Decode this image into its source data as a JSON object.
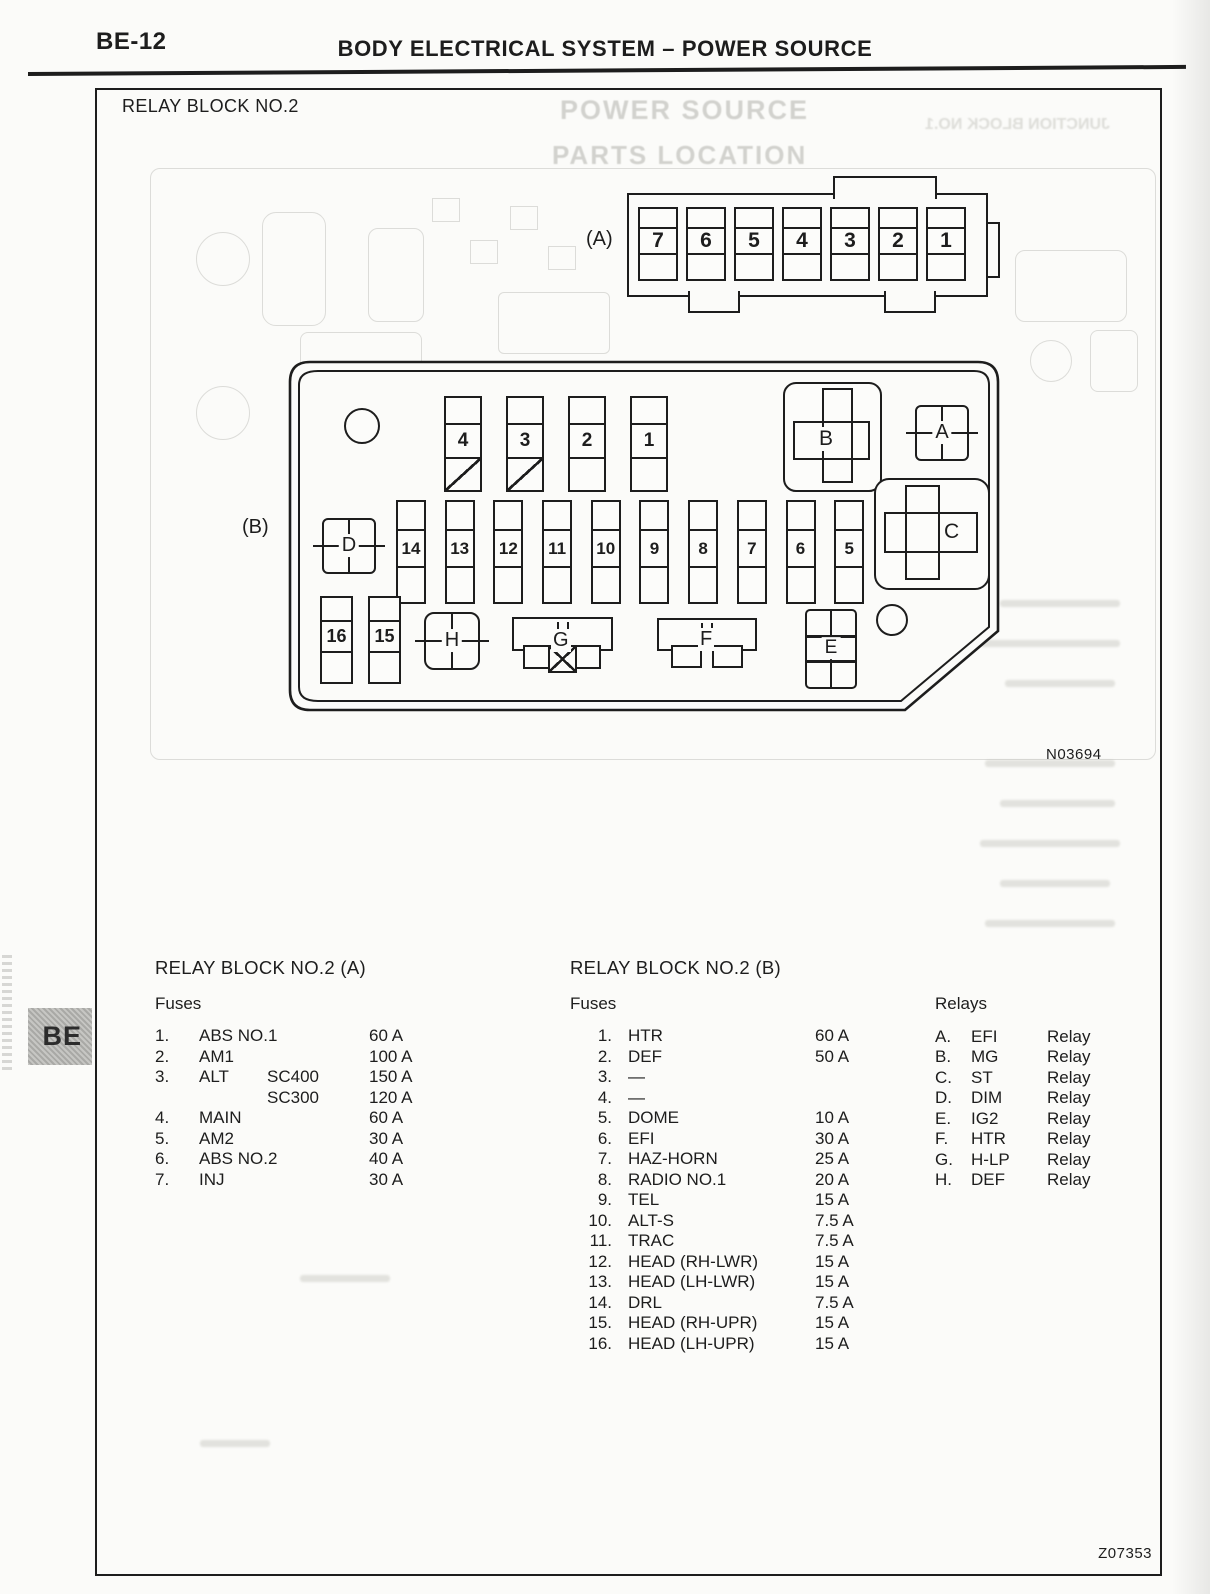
{
  "page": {
    "page_number": "BE-12",
    "header_title": "BODY ELECTRICAL SYSTEM – POWER SOURCE",
    "section_title": "RELAY BLOCK NO.2",
    "figure_code": "N03694",
    "page_code": "Z07353",
    "side_tab": "BE"
  },
  "ghost": {
    "bleed_line1": "POWER SOURCE",
    "bleed_line2": "PARTS LOCATION",
    "bleed_line3": "JUNCTION BLOCK NO.1"
  },
  "diagram": {
    "connector_a": {
      "label": "(A)",
      "slots": [
        "7",
        "6",
        "5",
        "4",
        "3",
        "2",
        "1"
      ]
    },
    "block_b": {
      "label": "(B)",
      "top_fuses": [
        "4",
        "3",
        "2",
        "1"
      ],
      "mid_fuses": [
        "14",
        "13",
        "12",
        "11",
        "10",
        "9",
        "8",
        "7",
        "6",
        "5"
      ],
      "bottom_fuses": [
        "16",
        "15"
      ],
      "relay_letters": [
        "A",
        "B",
        "C",
        "D",
        "E",
        "F",
        "G",
        "H"
      ]
    }
  },
  "tables": {
    "block_a": {
      "title": "RELAY BLOCK NO.2 (A)",
      "subtitle": "Fuses",
      "rows": [
        {
          "num": "1.",
          "name": "ABS NO.1",
          "variant": "",
          "amp": "60 A"
        },
        {
          "num": "2.",
          "name": "AM1",
          "variant": "",
          "amp": "100 A"
        },
        {
          "num": "3.",
          "name": "ALT",
          "variant": "SC400",
          "amp": "150 A"
        },
        {
          "num": "",
          "name": "",
          "variant": "SC300",
          "amp": "120 A"
        },
        {
          "num": "4.",
          "name": "MAIN",
          "variant": "",
          "amp": "60 A"
        },
        {
          "num": "5.",
          "name": "AM2",
          "variant": "",
          "amp": "30 A"
        },
        {
          "num": "6.",
          "name": "ABS NO.2",
          "variant": "",
          "amp": "40 A"
        },
        {
          "num": "7.",
          "name": "INJ",
          "variant": "",
          "amp": "30 A"
        }
      ]
    },
    "block_b": {
      "title": "RELAY BLOCK NO.2 (B)",
      "subtitle": "Fuses",
      "rows": [
        {
          "num": "1.",
          "name": "HTR",
          "amp": "60 A"
        },
        {
          "num": "2.",
          "name": "DEF",
          "amp": "50 A"
        },
        {
          "num": "3.",
          "name": "—",
          "amp": ""
        },
        {
          "num": "4.",
          "name": "—",
          "amp": ""
        },
        {
          "num": "5.",
          "name": "DOME",
          "amp": "10 A"
        },
        {
          "num": "6.",
          "name": "EFI",
          "amp": "30 A"
        },
        {
          "num": "7.",
          "name": "HAZ-HORN",
          "amp": "25 A"
        },
        {
          "num": "8.",
          "name": "RADIO NO.1",
          "amp": "20 A"
        },
        {
          "num": "9.",
          "name": "TEL",
          "amp": "15 A"
        },
        {
          "num": "10.",
          "name": "ALT-S",
          "amp": "7.5 A"
        },
        {
          "num": "11.",
          "name": "TRAC",
          "amp": "7.5 A"
        },
        {
          "num": "12.",
          "name": "HEAD (RH-LWR)",
          "amp": "15 A"
        },
        {
          "num": "13.",
          "name": "HEAD (LH-LWR)",
          "amp": "15 A"
        },
        {
          "num": "14.",
          "name": "DRL",
          "amp": "7.5 A"
        },
        {
          "num": "15.",
          "name": "HEAD (RH-UPR)",
          "amp": "15 A"
        },
        {
          "num": "16.",
          "name": "HEAD (LH-UPR)",
          "amp": "15 A"
        }
      ]
    },
    "relays": {
      "title": "Relays",
      "rows": [
        {
          "letter": "A.",
          "name": "EFI",
          "type": "Relay"
        },
        {
          "letter": "B.",
          "name": "MG",
          "type": "Relay"
        },
        {
          "letter": "C.",
          "name": "ST",
          "type": "Relay"
        },
        {
          "letter": "D.",
          "name": "DIM",
          "type": "Relay"
        },
        {
          "letter": "E.",
          "name": "IG2",
          "type": "Relay"
        },
        {
          "letter": "F.",
          "name": "HTR",
          "type": "Relay"
        },
        {
          "letter": "G.",
          "name": "H-LP",
          "type": "Relay"
        },
        {
          "letter": "H.",
          "name": "DEF",
          "type": "Relay"
        }
      ]
    }
  }
}
